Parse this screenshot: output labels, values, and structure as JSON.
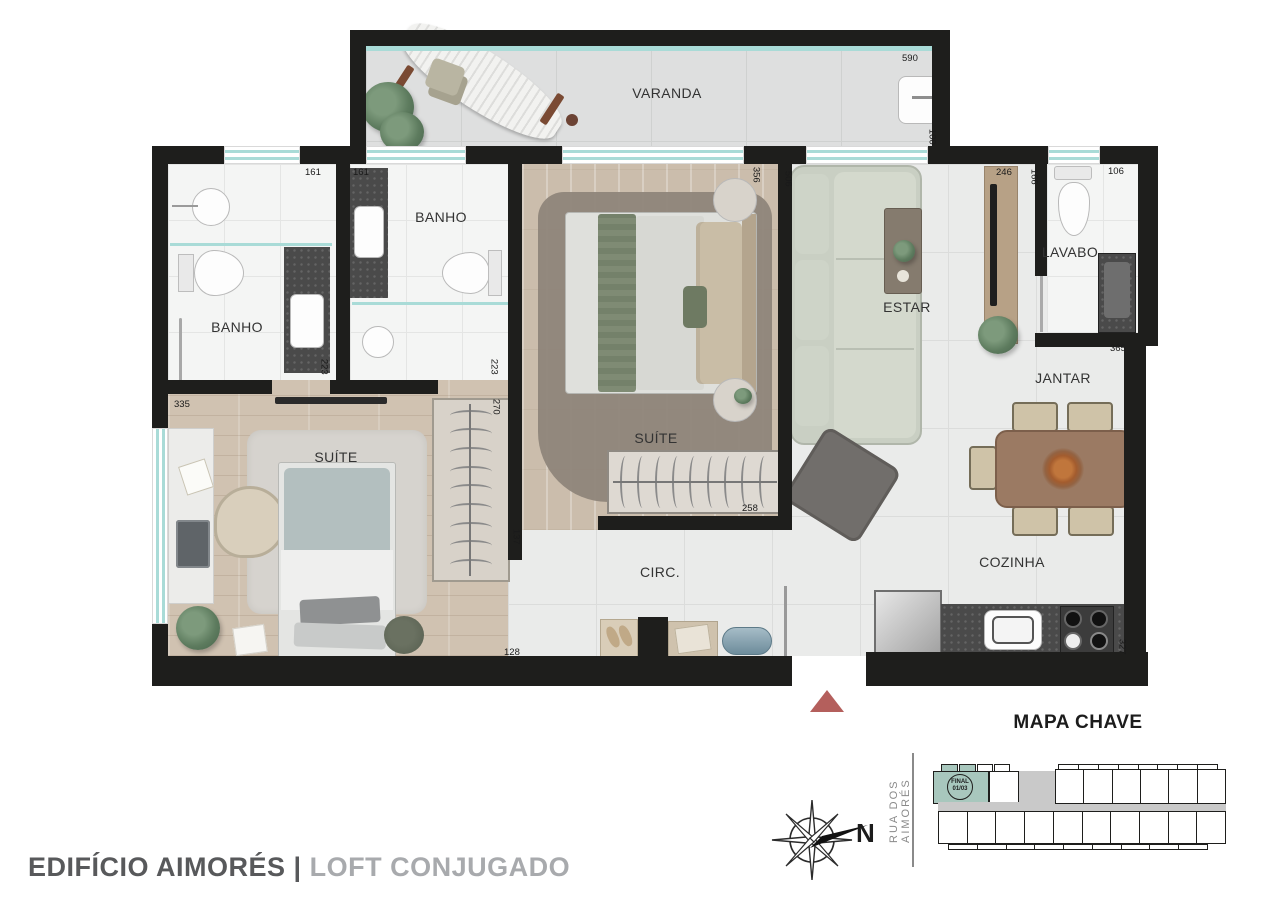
{
  "title": {
    "building": "EDIFÍCIO AIMORÉS",
    "divider": "|",
    "variant": "LOFT CONJUGADO"
  },
  "rooms": {
    "varanda": "VARANDA",
    "banho_left": "BANHO",
    "banho_right": "BANHO",
    "suite_center": "SUÍTE",
    "suite_left": "SUÍTE",
    "estar": "ESTAR",
    "lavabo": "LAVABO",
    "jantar": "JANTAR",
    "cozinha": "COZINHA",
    "circulacao": "CIRC."
  },
  "dimensions": {
    "varanda_width": "590",
    "varanda_depth": "100",
    "banho_left_width": "161",
    "banho_right_width": "161",
    "banho_left_depth": "223",
    "banho_right_depth": "223",
    "suite_left_closet": "270",
    "suite_left_width": "335",
    "suite_center_width": "356",
    "estar_depth": "506",
    "tv_panel_width": "246",
    "lavabo_width": "166",
    "lavabo_depth": "106",
    "jantar_width": "365",
    "suite_center_closet": "258",
    "circ_width": "137",
    "suite_left_door": "128",
    "cozinha_width": "327"
  },
  "key_map": {
    "title": "MAPA CHAVE",
    "street": "RUA DOS AIMORÉS",
    "badge_line1": "FINAL",
    "badge_line2": "01/03",
    "north": "N"
  },
  "colors": {
    "wall": "#1e1e1c",
    "window_glass": "#a9dbd7",
    "wood_floor": "#cdbfae",
    "tile_floor": "#eaebea",
    "bath_floor": "#f4f5f4",
    "highlight_unit": "#a8c7bd",
    "entrance_marker": "#b45f5c",
    "title_primary": "#58595b",
    "title_secondary": "#a8aaad"
  }
}
